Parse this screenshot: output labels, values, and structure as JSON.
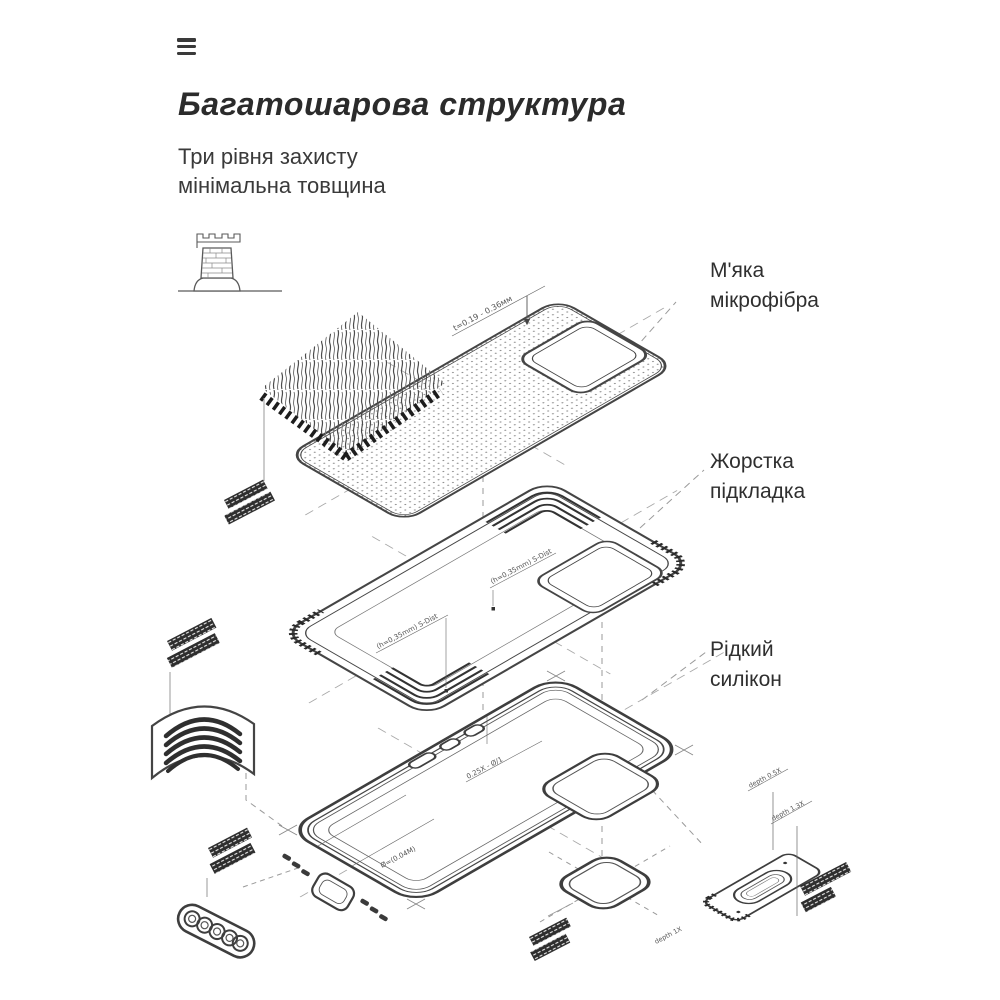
{
  "heading": {
    "title": "Багатошарова структура",
    "subtitle_line1": "Три рівня захисту",
    "subtitle_line2": "мінімальна товщина"
  },
  "layer_labels": {
    "microfiber": {
      "line1": "М'яка",
      "line2": "мікрофібра"
    },
    "hard_liner": {
      "line1": "Жорстка",
      "line2": "підкладка"
    },
    "silicone": {
      "line1": "Рідкий",
      "line2": "силікон"
    }
  },
  "annotations": {
    "microfiber_thickness": "t=0.19 - 0.36мм",
    "liner_dim_left": "(h=0,35mm) S-Dist",
    "liner_dim_right": "(h=0,35mm) S-Dist",
    "case_buttons_dim": "0.25X - Ø/1",
    "case_floor_dim": "Ø=(0.04M)",
    "plate_depth_top": "depth 0.5X",
    "plate_depth_bottom": "depth 1.3X",
    "plate_depth_left": "depth 1X"
  },
  "icons": {
    "menu": "hamburger-menu-icon",
    "tower": "castle-tower-icon"
  },
  "colors": {
    "ink": "#2b2b2b",
    "line": "#474747",
    "dash": "#9a9a9a",
    "tag": "#2e2e2e"
  }
}
